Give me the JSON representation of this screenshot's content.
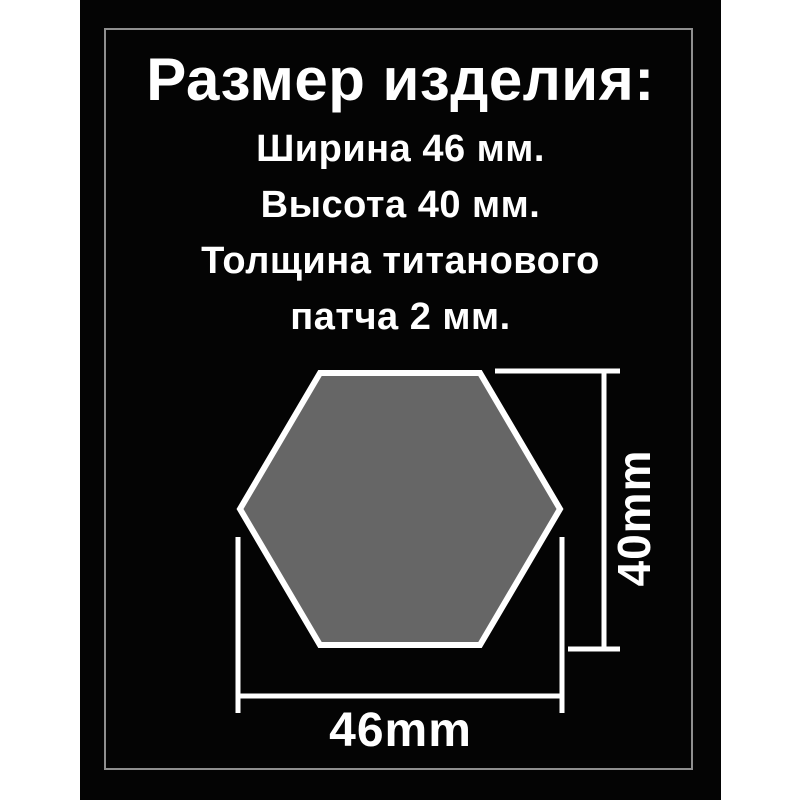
{
  "page": {
    "background_color": "#ffffff",
    "card_color": "#040404",
    "frame_color": "#8f8f8f",
    "text_color": "#ffffff"
  },
  "title": "Размер изделия:",
  "specs": {
    "lines": [
      "Ширина 46 мм.",
      "Высота 40 мм.",
      "Толщина титанового",
      "патча 2 мм."
    ]
  },
  "diagram": {
    "shape": "hexagon",
    "fill": "#666666",
    "outline": "#ffffff",
    "dimension_line_color": "#ffffff",
    "width_label": "46mm",
    "height_label": "40mm"
  }
}
